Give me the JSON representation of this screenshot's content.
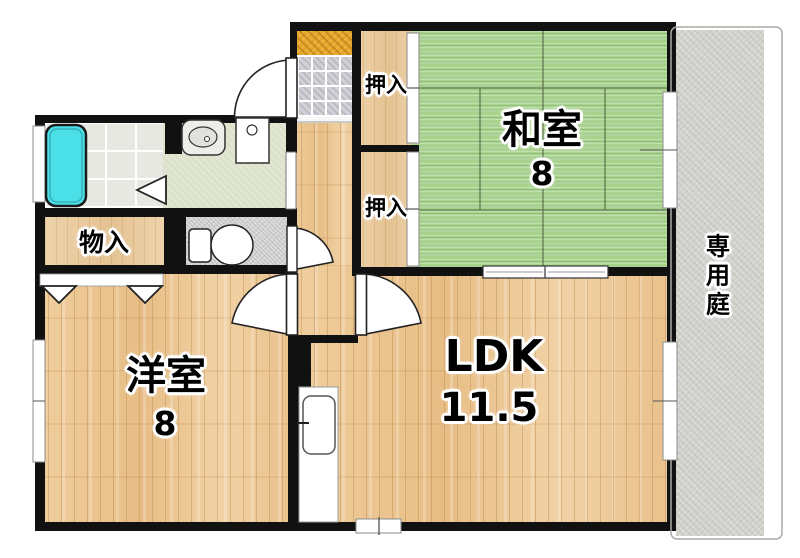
{
  "plan_title": "apartment-floorplan",
  "rooms": {
    "washitsu": {
      "name": "和室",
      "size": "8"
    },
    "ldk": {
      "name": "LDK",
      "size": "11.5"
    },
    "youshitsu": {
      "name": "洋室",
      "size": "8"
    },
    "closet_upper": {
      "name": "押入"
    },
    "closet_lower": {
      "name": "押入"
    },
    "storage": {
      "name": "物入"
    },
    "garden": {
      "name": "専用庭"
    }
  },
  "colors": {
    "wall": "#111111",
    "tatami": "#a9d28f",
    "wood": "#ecc694",
    "bathtub": "#4be0e7",
    "entrance_step": "#e6a72c",
    "garden": "#d4d4cf",
    "washroom_floor": "#e2e7d3"
  }
}
